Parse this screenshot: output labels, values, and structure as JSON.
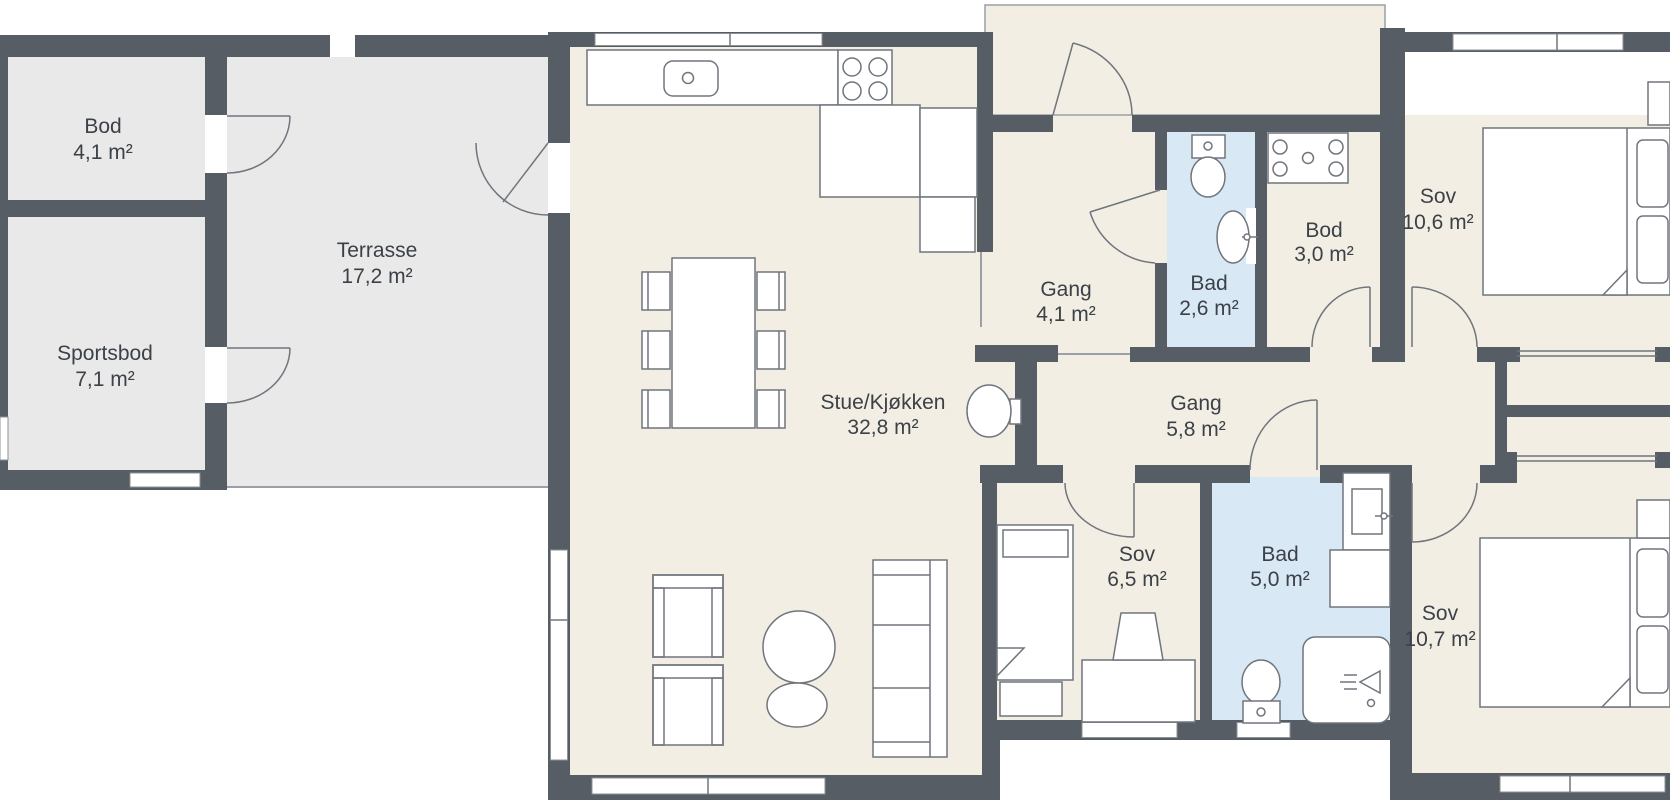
{
  "plan": {
    "type": "floor-plan",
    "language": "Norwegian",
    "rooms": [
      {
        "id": "bod-annex",
        "name": "Bod",
        "area": "4,1 m²"
      },
      {
        "id": "sportsbod",
        "name": "Sportsbod",
        "area": "7,1 m²"
      },
      {
        "id": "terrasse",
        "name": "Terrasse",
        "area": "17,2 m²"
      },
      {
        "id": "stue-kjokken",
        "name": "Stue/Kjøkken",
        "area": "32,8 m²"
      },
      {
        "id": "gang-entre",
        "name": "Gang",
        "area": "4,1 m²"
      },
      {
        "id": "bad-liten",
        "name": "Bad",
        "area": "2,6 m²"
      },
      {
        "id": "bod-indre",
        "name": "Bod",
        "area": "3,0 m²"
      },
      {
        "id": "sov-stor",
        "name": "Sov",
        "area": "10,6 m²"
      },
      {
        "id": "gang-indre",
        "name": "Gang",
        "area": "5,8 m²"
      },
      {
        "id": "sov-liten",
        "name": "Sov",
        "area": "6,5 m²"
      },
      {
        "id": "bad-stor",
        "name": "Bad",
        "area": "5,0 m²"
      },
      {
        "id": "sov-sor",
        "name": "Sov",
        "area": "10,7 m²"
      }
    ],
    "colors": {
      "wall": "#575d65",
      "floor_main": "#f2eee3",
      "floor_annex": "#e9e9e9",
      "floor_bath": "#d8e8f5",
      "fixture_stroke": "#70757d",
      "label_text": "#3c4148",
      "background": "#ffffff"
    },
    "fixtures": [
      "kitchen-sink",
      "stove",
      "kitchen-cabinets",
      "dining-table",
      "dining-chairs",
      "wall-basin",
      "armchairs",
      "coffee-tables",
      "sofa",
      "toilet",
      "washbasin",
      "laundry-unit",
      "double-bed",
      "single-bed",
      "pillows",
      "nightstand",
      "dresser",
      "desk",
      "desk-chair",
      "wardrobe-sliding-doors",
      "shower",
      "vanity-sink",
      "bathroom-counter",
      "windows",
      "door-swings"
    ]
  }
}
